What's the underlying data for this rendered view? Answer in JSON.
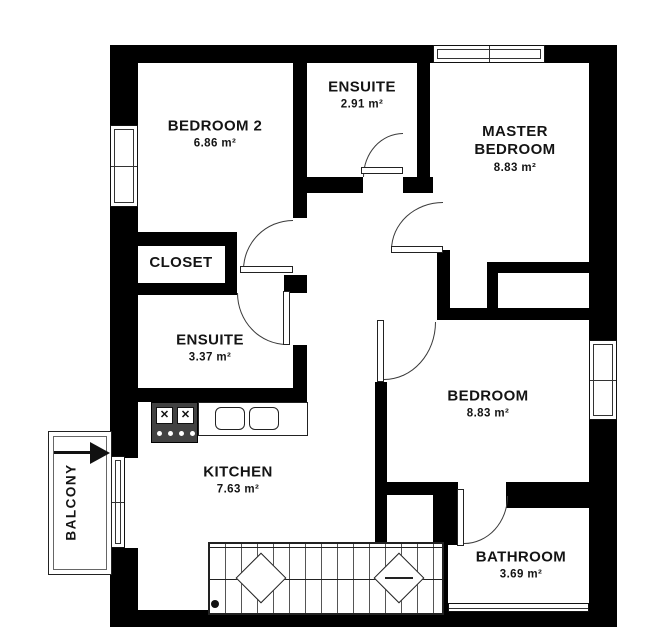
{
  "plan": {
    "title": "apartment-floor-plan",
    "rooms": [
      {
        "id": "bedroom2",
        "name": "BEDROOM 2",
        "area": "6.86 m²"
      },
      {
        "id": "ensuite-top",
        "name": "ENSUITE",
        "area": "2.91 m²"
      },
      {
        "id": "master-bedroom",
        "name": "MASTER BEDROOM",
        "area": "8.83 m²"
      },
      {
        "id": "closet",
        "name": "CLOSET",
        "area": ""
      },
      {
        "id": "ensuite-lower",
        "name": "ENSUITE",
        "area": "3.37 m²"
      },
      {
        "id": "kitchen",
        "name": "KITCHEN",
        "area": "7.63 m²"
      },
      {
        "id": "bedroom",
        "name": "BEDROOM",
        "area": "8.83 m²"
      },
      {
        "id": "bathroom",
        "name": "BATHROOM",
        "area": "3.69 m²"
      },
      {
        "id": "balcony",
        "name": "BALCONY",
        "area": ""
      }
    ],
    "fixtures": {
      "stove": "stove-icon",
      "sink": "double-sink-icon",
      "stairs": "staircase",
      "entrance_arrow": "entry-arrow-icon"
    },
    "colors": {
      "wall": "#000000",
      "door_arc": "#3a3a3a",
      "background": "#ffffff",
      "fixture_dark": "#424242",
      "text": "#141414"
    }
  }
}
